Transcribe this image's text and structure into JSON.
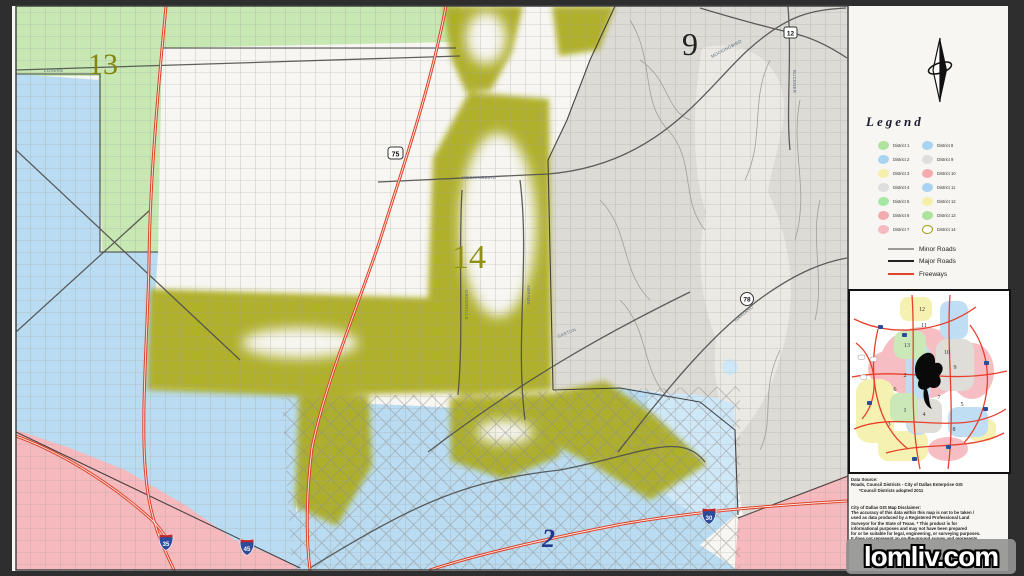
{
  "colors": {
    "district_green": "#c7e8b2",
    "district_blue": "#badcf2",
    "district_gray": "#dcdbd5",
    "district_gray_lake": "#ebe9e3",
    "district_pink": "#f6b9be",
    "district14_olive": "#abab1e",
    "water_blue": "#cfe8f8",
    "freeway_red": "#de452c",
    "major_road": "#4f4f4d",
    "minor_road": "#a6a5a2"
  },
  "map": {
    "labels": {
      "d13": "13",
      "d14": "14",
      "d9": "9",
      "d2": "2"
    },
    "road_labels": [
      {
        "text": "LOVERS"
      },
      {
        "text": "MOCKINGBIRD"
      },
      {
        "text": "MOCKINGBIRD"
      },
      {
        "text": "GASTON"
      },
      {
        "text": "GARLAND"
      },
      {
        "text": "BUCKNER"
      },
      {
        "text": "GREENVILLE"
      },
      {
        "text": "ABRAMS"
      }
    ],
    "shields": {
      "us75": "75",
      "tx12": "12",
      "tx78": "78",
      "i30": "30",
      "i45": "45",
      "i35": "35"
    }
  },
  "panel": {
    "legend": {
      "title": "Legend",
      "districts": [
        {
          "label": "District 1",
          "color": "#aee39d"
        },
        {
          "label": "District 2",
          "color": "#a9d4f1"
        },
        {
          "label": "District 3",
          "color": "#f4f0ab"
        },
        {
          "label": "District 4",
          "color": "#dedede"
        },
        {
          "label": "District 5",
          "color": "#a5e8a4"
        },
        {
          "label": "District 6",
          "color": "#f3abb0"
        },
        {
          "label": "District 7",
          "color": "#f6bac1"
        },
        {
          "label": "District 8",
          "color": "#a9d4f1"
        },
        {
          "label": "District 9",
          "color": "#dedede"
        },
        {
          "label": "District 10",
          "color": "#f3abb0"
        },
        {
          "label": "District 11",
          "color": "#a9d4f1"
        },
        {
          "label": "District 12",
          "color": "#f4f0ab"
        },
        {
          "label": "District 13",
          "color": "#aee39d"
        },
        {
          "label": "District 14",
          "color": "#ffffff",
          "border": "#9a9a10"
        }
      ],
      "roads": [
        {
          "label": "Minor Roads",
          "color": "#9a9a98"
        },
        {
          "label": "Major Roads",
          "color": "#222222"
        },
        {
          "label": "Freeways",
          "color": "#e0452c"
        }
      ]
    },
    "inset": {
      "numbers": [
        "12",
        "11",
        "13",
        "10",
        "9",
        "2",
        "6",
        "7",
        "5",
        "1",
        "4",
        "3",
        "8"
      ]
    },
    "source_lines": [
      "Data Source:",
      "Roads, Council Districts - City of Dallas Enterprise GIS",
      "*Council Districts adopted 2011"
    ],
    "disclaimer_lines": [
      "City of Dallas GIS Map Disclaimer:",
      "The accuracy of this data within this map is not to be taken /",
      "used as data produced by a Registered Professional Land",
      "Surveyor for the State of Texas. * This product is for",
      "informational purposes and may not have been prepared",
      "for or be suitable for legal, engineering, or surveying purposes.",
      "It does not represent an on-the-ground survey and represents"
    ]
  },
  "watermark": {
    "text": "lomliv.com"
  }
}
